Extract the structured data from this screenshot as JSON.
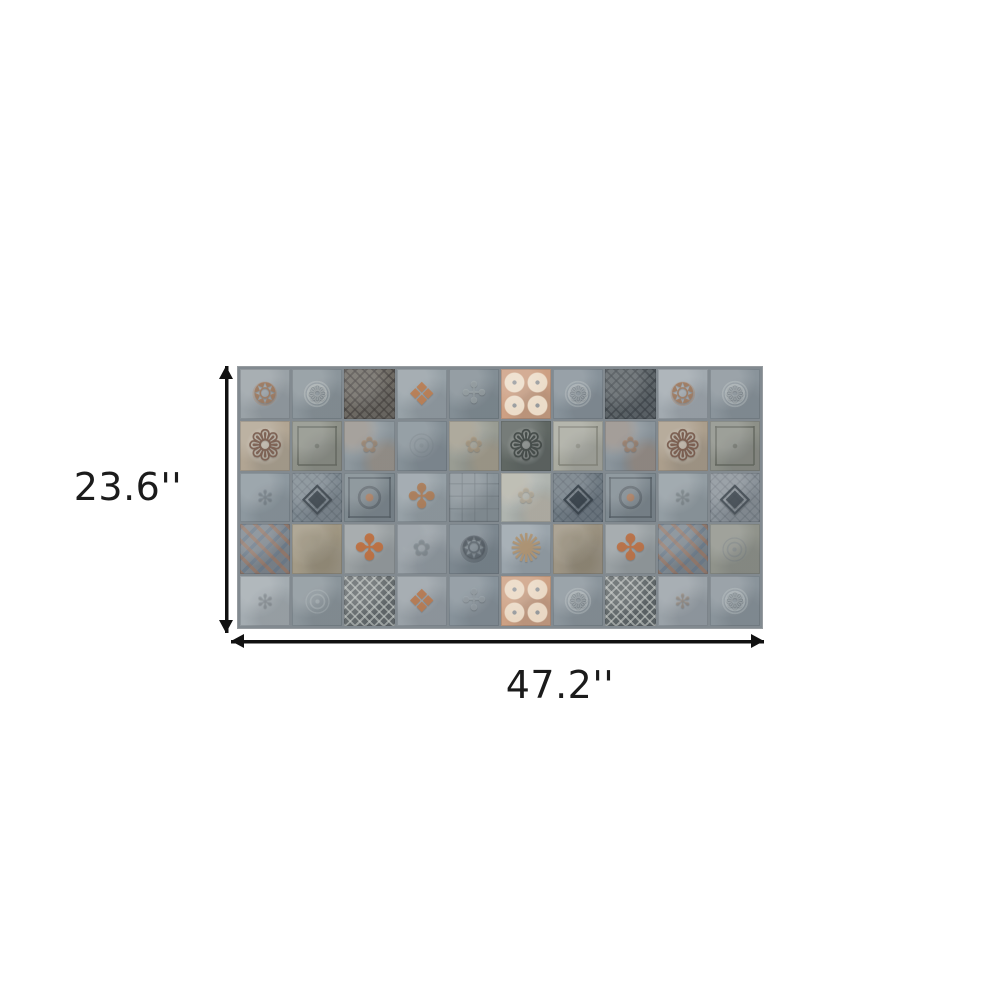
{
  "page": {
    "background_color": "#ffffff"
  },
  "diagram": {
    "height_label": "23.6''",
    "width_label": "47.2''",
    "label_color": "#1b1b1b",
    "arrow_color": "#111111",
    "icons": {
      "height_arrow_icon": "double-headed-vertical-arrow",
      "width_arrow_icon": "double-headed-horizontal-arrow"
    },
    "panel": {
      "description": "patchwork-mosaic-tile-mural",
      "rows": 5,
      "columns": 10,
      "grout_color": "#828a90",
      "tiles": [
        {
          "base": "#9aa2a7",
          "accent": "#a1785a",
          "motif": "medallion"
        },
        {
          "base": "#8b959b",
          "accent": "#bcc2c1",
          "motif": "wreath"
        },
        {
          "base": "#6f6b64",
          "accent": "#433f3d",
          "motif": "starlattice"
        },
        {
          "base": "#97a1a7",
          "accent": "#bd7e52",
          "motif": "diamondfloral"
        },
        {
          "base": "#838e95",
          "accent": "#a7b0b3",
          "motif": "quatrefoil"
        },
        {
          "base": "#cda083",
          "accent": "#eee0cd",
          "motif": "rosettes",
          "center": "#8f9aa2"
        },
        {
          "base": "#87929a",
          "accent": "#b6bdbe",
          "motif": "wreath"
        },
        {
          "base": "#5e6569",
          "accent": "#3a4045",
          "motif": "starlattice"
        },
        {
          "base": "#a2aab0",
          "accent": "#a1785a",
          "motif": "medallion"
        },
        {
          "base": "#8a949b",
          "accent": "#b8bfc0",
          "motif": "wreath"
        },
        {
          "base": "#b1a593",
          "accent": "#77584a",
          "motif": "snowflake"
        },
        {
          "base": "#8e9188",
          "accent": "#62665e",
          "motif": "frame"
        },
        {
          "base": "#8d979d",
          "accent": "#b08a68",
          "motif": "damask"
        },
        {
          "base": "#859097",
          "accent": "#6d787f",
          "motif": "rings"
        },
        {
          "base": "#999c93",
          "accent": "#b49b7d",
          "motif": "damask"
        },
        {
          "base": "#606763",
          "accent": "#3e4543",
          "motif": "snowflake"
        },
        {
          "base": "#a9aaa0",
          "accent": "#7f8076",
          "motif": "frame"
        },
        {
          "base": "#8a949b",
          "accent": "#ad7f5d",
          "motif": "damask"
        },
        {
          "base": "#ab9e8c",
          "accent": "#745547",
          "motif": "snowflake"
        },
        {
          "base": "#8d9088",
          "accent": "#60645c",
          "motif": "frame"
        },
        {
          "base": "#8d989f",
          "accent": "#75808a",
          "motif": "plain"
        },
        {
          "base": "#7f8a92",
          "accent": "#3e474f",
          "motif": "diamondlattice"
        },
        {
          "base": "#7e898f",
          "accent": "#525b62",
          "motif": "circlesquare",
          "center": "#a8724f"
        },
        {
          "base": "#96a0a6",
          "accent": "#b07c55",
          "motif": "clover"
        },
        {
          "base": "#8a949a",
          "accent": "#6d767c",
          "motif": "grid"
        },
        {
          "base": "#afb4af",
          "accent": "#c4b39b",
          "motif": "damask"
        },
        {
          "base": "#707b84",
          "accent": "#333d46",
          "motif": "diamondlattice"
        },
        {
          "base": "#7e8990",
          "accent": "#525b62",
          "motif": "circlesquare",
          "center": "#a8724f"
        },
        {
          "base": "#939da3",
          "accent": "#7b868d",
          "motif": "plain"
        },
        {
          "base": "#8b939a",
          "accent": "#424b53",
          "motif": "diamondlattice"
        },
        {
          "base": "#7f8890",
          "accent": "#a86f4e",
          "motif": "argyle",
          "alt": "#5e7185"
        },
        {
          "base": "#a39a86",
          "accent": "#837a64",
          "motif": "mottle"
        },
        {
          "base": "#9aa0a2",
          "accent": "#c06f3e",
          "motif": "crossfloral"
        },
        {
          "base": "#99a1a7",
          "accent": "#7f8a91",
          "motif": "damask"
        },
        {
          "base": "#7c878f",
          "accent": "#4e575f",
          "motif": "lacemedallion"
        },
        {
          "base": "#9aa4ab",
          "accent": "#b3946f",
          "motif": "starburst"
        },
        {
          "base": "#9e9584",
          "accent": "#7c735d",
          "motif": "mottle"
        },
        {
          "base": "#99a0a3",
          "accent": "#bd7044",
          "motif": "crossfloral"
        },
        {
          "base": "#7e8890",
          "accent": "#a86f4e",
          "motif": "argyle",
          "alt": "#5e7185"
        },
        {
          "base": "#90938b",
          "accent": "#6b7379",
          "motif": "rings"
        },
        {
          "base": "#a4acb1",
          "accent": "#838d94",
          "motif": "plain"
        },
        {
          "base": "#8b959b",
          "accent": "#a9b2b5",
          "motif": "rings"
        },
        {
          "base": "#656b6d",
          "accent": "#c3c8c5",
          "motif": "starlattice"
        },
        {
          "base": "#99a1a7",
          "accent": "#b97a50",
          "motif": "diamondfloral"
        },
        {
          "base": "#87929a",
          "accent": "#a3acb1",
          "motif": "quatrefoil"
        },
        {
          "base": "#cda184",
          "accent": "#ecdcc8",
          "motif": "rosettes",
          "center": "#8f9aa2"
        },
        {
          "base": "#8b959c",
          "accent": "#b8bfc1",
          "motif": "wreath"
        },
        {
          "base": "#5f6668",
          "accent": "#c6cac7",
          "motif": "starlattice"
        },
        {
          "base": "#9aa2a8",
          "accent": "#ab8560",
          "motif": "plain"
        },
        {
          "base": "#8a949b",
          "accent": "#b4bcbe",
          "motif": "wreath"
        }
      ]
    }
  }
}
